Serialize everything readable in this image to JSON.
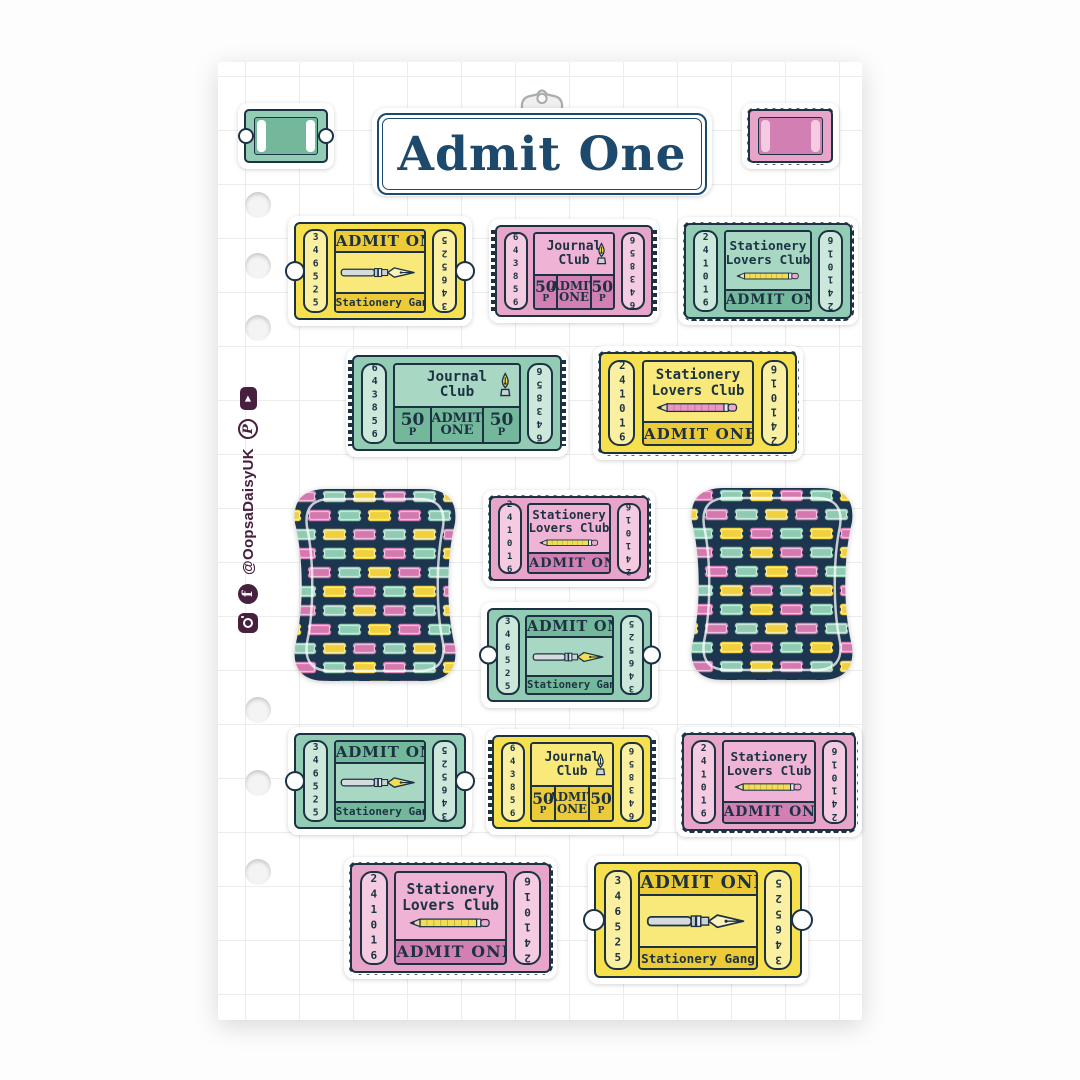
{
  "palette": {
    "ink_navy": "#1C3243",
    "sign_navy": "#1D4A6C",
    "pattern_navy": "#1C3650",
    "social_plum": "#46203E",
    "yellow": "#F7E04E",
    "pink": "#E8A5CA",
    "teal": "#93CCB4",
    "page_white": "#FFFFFF"
  },
  "header": {
    "sign_title": "Admit One",
    "clip_icon": "metal-clip-icon"
  },
  "sidebar": {
    "handle": "@OopsaDaisyUK",
    "icons": [
      {
        "name": "instagram-icon"
      },
      {
        "name": "facebook-icon",
        "glyph": "f"
      },
      {
        "name": "pinterest-icon",
        "glyph": "P"
      },
      {
        "name": "youtube-icon",
        "glyph": "▶"
      }
    ]
  },
  "tickets": {
    "admit_gang": {
      "top": "ADMIT ONE",
      "bottom": "Stationery Gang",
      "serial": "346525",
      "icon": "fountain-pen-icon"
    },
    "journal": {
      "title1": "Journal",
      "title2": "Club",
      "price": "50",
      "unit": "P",
      "admit1": "ADMIT",
      "admit2": "ONE",
      "serial": "643856",
      "icon": "pen-nib-icon"
    },
    "lovers": {
      "title1": "Stationery",
      "title2": "Lovers Club",
      "bottom": "ADMIT ONE",
      "serial": "241016",
      "icon": "pencil-icon"
    }
  },
  "sheet_stickers": [
    {
      "position": "top-left",
      "type": "mini-blank-ticket",
      "color": "teal"
    },
    {
      "position": "top-center",
      "type": "admit-one-sign",
      "color": "white"
    },
    {
      "position": "top-right",
      "type": "mini-blank-ticket",
      "color": "pink"
    },
    {
      "row": 1,
      "type": "admit-gang",
      "color": "yellow"
    },
    {
      "row": 1,
      "type": "journal-club",
      "color": "pink"
    },
    {
      "row": 1,
      "type": "lovers-club",
      "color": "teal"
    },
    {
      "row": 2,
      "type": "journal-club",
      "color": "teal"
    },
    {
      "row": 2,
      "type": "lovers-club",
      "color": "yellow"
    },
    {
      "row": 3,
      "type": "ticket-pattern",
      "color": "navy"
    },
    {
      "row": 3,
      "type": "lovers-club",
      "color": "pink"
    },
    {
      "row": 3,
      "type": "admit-gang",
      "color": "teal"
    },
    {
      "row": 3,
      "type": "ticket-pattern",
      "color": "navy"
    },
    {
      "row": 4,
      "type": "admit-gang",
      "color": "teal"
    },
    {
      "row": 4,
      "type": "journal-club",
      "color": "yellow"
    },
    {
      "row": 4,
      "type": "lovers-club",
      "color": "pink"
    },
    {
      "row": 5,
      "type": "lovers-club",
      "color": "pink"
    },
    {
      "row": 5,
      "type": "admit-gang",
      "color": "yellow"
    }
  ]
}
